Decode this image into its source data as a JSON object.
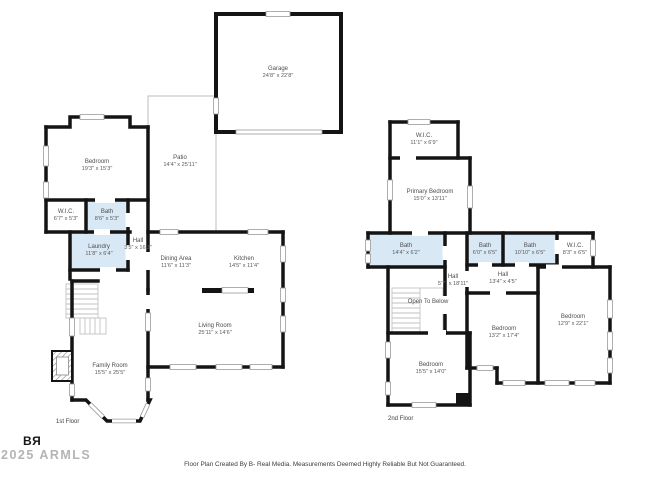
{
  "page": {
    "footer": "Floor Plan Created By B- Real Media. Measurements Deemed Highly Reliable But Not Guaranteed.",
    "logo_text": "BЯ",
    "watermark": "2025 ARMLS"
  },
  "colors": {
    "wall": "#141414",
    "bath_fill": "#d9e8f5"
  },
  "floor1": {
    "label": "1st Floor",
    "rooms": {
      "garage": {
        "name": "Garage",
        "dims": "24'8\" x 22'8\""
      },
      "patio": {
        "name": "Patio",
        "dims": "14'4\" x 25'11\""
      },
      "bedroom": {
        "name": "Bedroom",
        "dims": "19'3\" x 15'3\""
      },
      "wic": {
        "name": "W.I.C.",
        "dims": "6'7\" x 5'3\""
      },
      "bath": {
        "name": "Bath",
        "dims": "8'6\" x 5'3\""
      },
      "laundry": {
        "name": "Laundry",
        "dims": "11'8\" x 6'4\""
      },
      "hall": {
        "name": "Hall",
        "dims": "3'5\" x 16'3\""
      },
      "dining": {
        "name": "Dining Area",
        "dims": "11'6\" x 11'3\""
      },
      "kitchen": {
        "name": "Kitchen",
        "dims": "14'5\" x 11'4\""
      },
      "living": {
        "name": "Living Room",
        "dims": "25'11\" x 14'6\""
      },
      "family": {
        "name": "Family Room",
        "dims": "15'5\" x 25'5\""
      }
    }
  },
  "floor2": {
    "label": "2nd Floor",
    "rooms": {
      "wic_top": {
        "name": "W.I.C.",
        "dims": "11'1\" x 6'9\""
      },
      "primary": {
        "name": "Primary Bedroom",
        "dims": "15'0\" x 13'11\""
      },
      "bath_left": {
        "name": "Bath",
        "dims": "14'4\" x 6'2\""
      },
      "bath_mid": {
        "name": "Bath",
        "dims": "6'0\" x 6'5\""
      },
      "bath_right": {
        "name": "Bath",
        "dims": "10'10\" x 6'5\""
      },
      "wic_right": {
        "name": "W.I.C.",
        "dims": "8'3\" x 6'5\""
      },
      "hall_vert": {
        "name": "Hall",
        "dims": "5'7\" x 18'11\""
      },
      "hall_horiz": {
        "name": "Hall",
        "dims": "13'4\" x 4'5\""
      },
      "open_below": {
        "name": "Open To Below",
        "dims": ""
      },
      "bedroom_left": {
        "name": "Bedroom",
        "dims": "15'5\" x 14'0\""
      },
      "bedroom_mid": {
        "name": "Bedroom",
        "dims": "13'2\" x 17'4\""
      },
      "bedroom_right": {
        "name": "Bedroom",
        "dims": "12'9\" x 22'1\""
      }
    }
  }
}
